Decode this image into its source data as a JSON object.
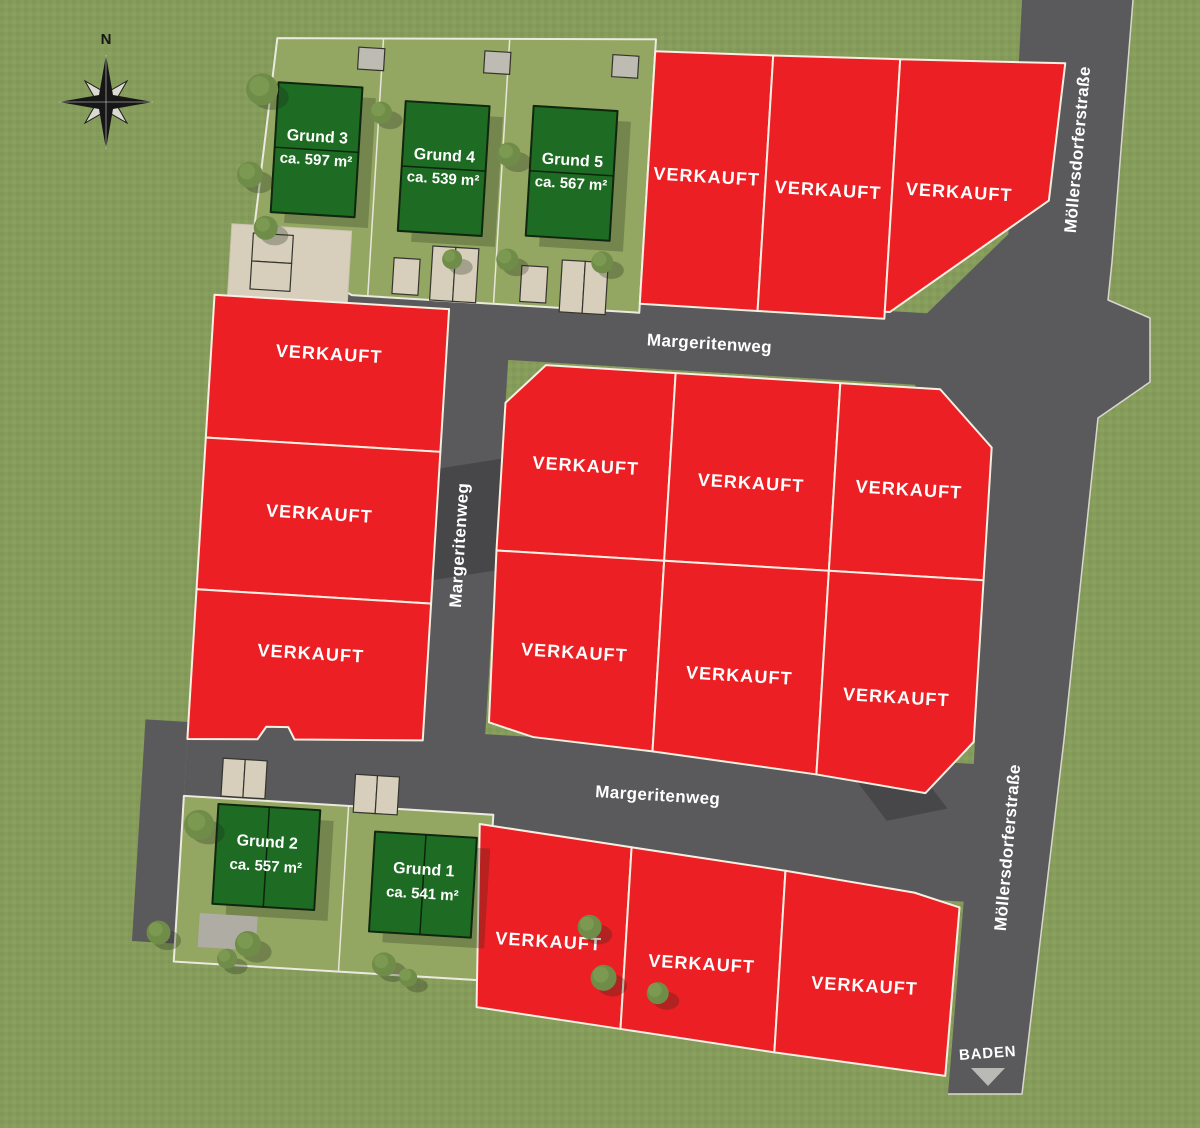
{
  "compass": {
    "north_label": "N"
  },
  "streets": {
    "margeritenweg": "Margeritenweg",
    "moellersdorferstrasse": "Möllersdorferstraße",
    "baden": "BADEN"
  },
  "labels": {
    "sold": "VERKAUFT"
  },
  "available_plots": [
    {
      "name": "Grund 3",
      "area": "ca. 597 m²"
    },
    {
      "name": "Grund 4",
      "area": "ca. 539 m²"
    },
    {
      "name": "Grund 5",
      "area": "ca. 567 m²"
    },
    {
      "name": "Grund 2",
      "area": "ca. 557 m²"
    },
    {
      "name": "Grund 1",
      "area": "ca. 541 m²"
    }
  ],
  "counts": {
    "sold_plots": 15,
    "available_plots": 5
  },
  "colors": {
    "sold_red": "#EC2024",
    "available_green": "#1E6B24",
    "road_gray": "#5A5A5C",
    "grass_green": "#869C5A",
    "garden_green": "#93A662",
    "driveway_beige": "#D7CFBC"
  }
}
